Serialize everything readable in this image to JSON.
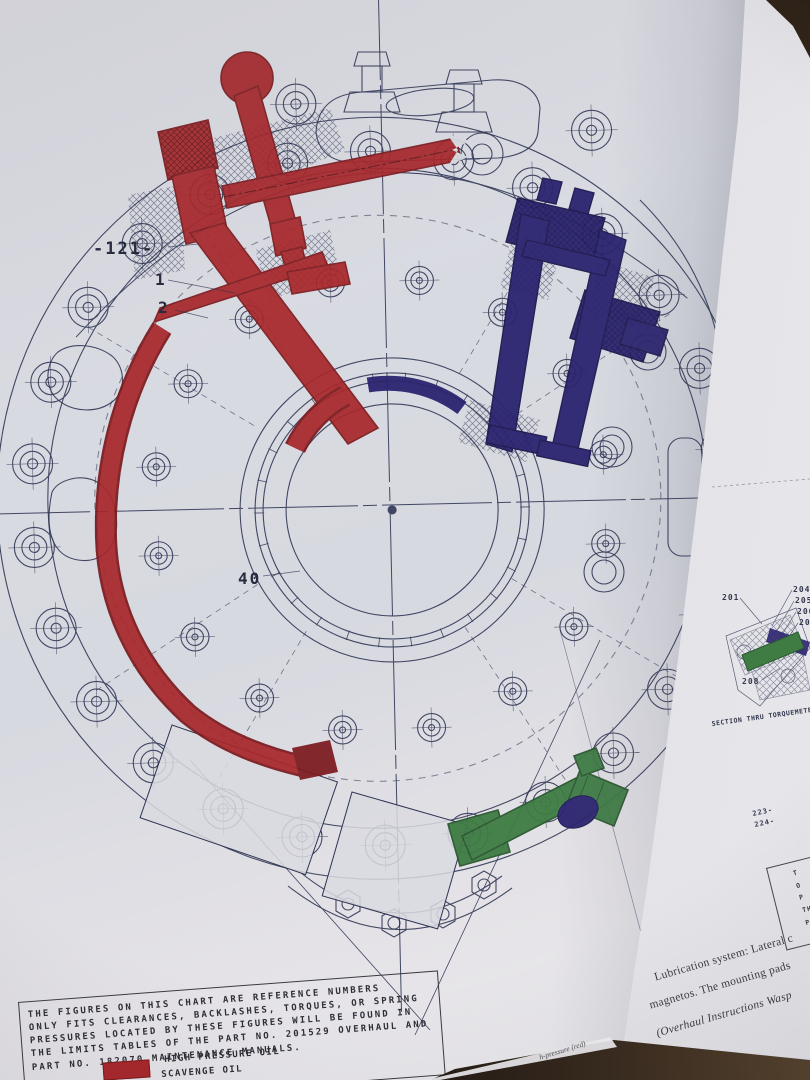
{
  "colors": {
    "hp_red": "#a8282c",
    "hp_red_dark": "#7c1b1f",
    "blue_oil": "#2b2470",
    "blue_oil_dark": "#1c184e",
    "green_oil": "#3e7c44",
    "green_oil_dark": "#2a5730",
    "ink": "#2d3352",
    "page_left": "#d9dbe1"
  },
  "diagram": {
    "callouts": {
      "c121": "-121-",
      "c1": "1",
      "c2": "2",
      "c40": "40"
    }
  },
  "note_box": {
    "lines": [
      "THE FIGURES ON THIS CHART ARE REFERENCE NUMBERS",
      "ONLY FITS CLEARANCES, BACKLASHES, TORQUES, OR SPRING",
      "PRESSURES LOCATED BY THESE FIGURES WILL BE FOUND IN",
      "THE LIMITS TABLES OF THE PART NO. 201529 OVERHAUL AND",
      "PART NO. 182070 MAINTENANCE MANUALS."
    ]
  },
  "legend": {
    "items": [
      {
        "label": "HIGH PRESSURE OIL"
      },
      {
        "label": "SCAVENGE OIL"
      }
    ]
  },
  "right_page": {
    "torquemeter": {
      "caption": "SECTION THRU TORQUEMETER",
      "callouts": {
        "c201": "201",
        "c204": "204",
        "c205": "205",
        "c206": "206",
        "c207": "207",
        "c208": "208",
        "c223": "223-",
        "c224": "224-"
      }
    },
    "note_fragments": [
      "T",
      "O",
      "P",
      "TH",
      "PA"
    ],
    "body_lines": [
      "Lubrication system: Lateral c",
      "magnetos. The mounting pads",
      "(Overhaul Instructions Wasp"
    ],
    "curl_caption": "h-pressure (red)"
  }
}
